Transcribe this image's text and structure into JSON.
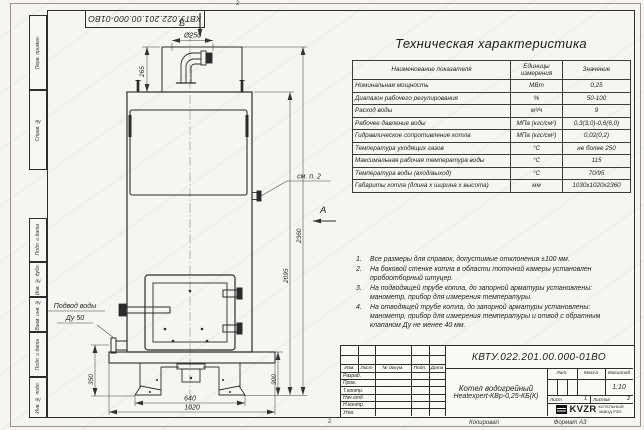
{
  "frame": {
    "top_doc_number": "КВТУ.022.201.00.000-01ВО",
    "left_margin_labels": [
      "Перв. примен.",
      "Справ. №",
      "Подп. и дата",
      "Инв. № дубл.",
      "Взам. инв. №",
      "Подп. и дата",
      "Инв. № подл."
    ],
    "zone_top": "2",
    "zone_bottom": "2",
    "footer": {
      "copied": "Копировал",
      "format": "Формат А3"
    }
  },
  "drawing": {
    "view_labels": {
      "b": "Б",
      "a": "А"
    },
    "callouts": {
      "see_note": "см. п. 2",
      "water_line1": "Подвод воды",
      "water_line2": "Ду 50"
    },
    "dimensions": {
      "chimney": "Ø250",
      "d265": "265",
      "d2360": "2360",
      "d2095": "2095",
      "d350": "350",
      "d300": "300",
      "d640": "640",
      "d1020": "1020"
    }
  },
  "spec_table": {
    "title": "Техническая характеристика",
    "headers": [
      "Наименование показателя",
      "Единицы измерения",
      "Значение"
    ],
    "rows": [
      [
        "Номинальная мощность",
        "МВт",
        "0,25"
      ],
      [
        "Диапазон рабочего регулирования",
        "%",
        "50-100"
      ],
      [
        "Расход воды",
        "м³/ч",
        "9"
      ],
      [
        "Рабочее давление воды",
        "МПа (кгс/см²)",
        "0,3(3,0)-0,6(6,0)"
      ],
      [
        "Гидравлическое сопротивление котла",
        "МПа (кгс/см²)",
        "0,02(0,2)"
      ],
      [
        "Температура уходящих газов",
        "°С",
        "не более 250"
      ],
      [
        "Максимальная рабочая температура воды",
        "°С",
        "115"
      ],
      [
        "Температура воды (вход/выход)",
        "°С",
        "70/95"
      ],
      [
        "Габариты котла (длина х ширина х высота)",
        "мм",
        "1030х1020х2360"
      ]
    ]
  },
  "notes": [
    {
      "num": "1.",
      "text": "Все размеры для справок, допустимые отклонения ±100 мм."
    },
    {
      "num": "2.",
      "text": "На боковой стенке котла в области топочной камеры установлен пробоотборный штуцер."
    },
    {
      "num": "3.",
      "text": "На подводящей трубе котла, до запорной арматуры установлены: манометр, прибор для измерения температуры."
    },
    {
      "num": "4.",
      "text": "На отводящей трубе котла, до запорной арматуры установлены: манометр, прибор для измерения температуры и отвод с обратным клапаном Ду не менее 40 мм."
    }
  ],
  "title_block": {
    "doc_number": "КВТУ.022.201.00.000-01ВО",
    "name_line1": "Котел водогрейный",
    "name_line2": "Heatexpert-КВр-0,25-КБ(К)",
    "columns": [
      "Изм.",
      "Лист",
      "№ докум.",
      "Подп.",
      "Дата"
    ],
    "row_labels": [
      "Разраб.",
      "Пров.",
      "Т.контр.",
      "Нач.отд.",
      "Н.контр.",
      "Утв."
    ],
    "lit_label": "Лит.",
    "mass_label": "Масса",
    "scale_label": "Масштаб",
    "scale_value": "1:10",
    "sheet_label": "Лист",
    "sheet_value": "1",
    "sheets_label": "Листов",
    "sheets_value": "2",
    "company_logo": "KVZR",
    "company_line1": "КОТЕЛЬНЫЙ",
    "company_line2": "ЗАВОД РЭП"
  }
}
